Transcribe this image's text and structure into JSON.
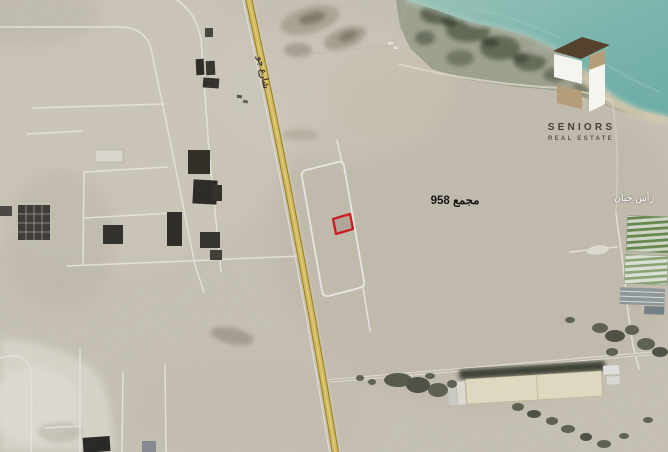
{
  "meta": {
    "type": "satellite-map-listing",
    "description": "Aerial satellite view of a land plot for sale beside a highway in a desert coastal area"
  },
  "labels": {
    "road": "شارع جو",
    "block": "مجمع 958",
    "district": "رأس حيان"
  },
  "logo": {
    "brand": "SENIORS",
    "tagline": "REAL ESTATE"
  },
  "marker": {
    "kind": "highlighted-plot-outline",
    "color": "#dd1c21"
  },
  "colors": {
    "desert": "#d5cfc2",
    "water": "#7ec0ba",
    "road_yellow": "#e8ca60",
    "road_edge": "#a8902e",
    "street_white": "#f7f5ef",
    "vegetation": "#4f5546",
    "marker_red": "#dd1c21",
    "logo_brown": "#55422c",
    "logo_tan": "#b69d79",
    "logo_white": "#f6f4ef"
  }
}
